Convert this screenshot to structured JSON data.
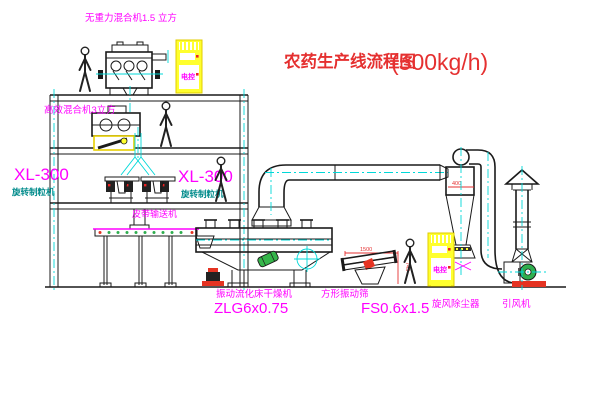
{
  "title": {
    "name": "农药生产线流程图",
    "capacity": "(500kg/h)"
  },
  "equipment": {
    "top_mixer": {
      "label": "无重力混合机1.5 立方"
    },
    "floor2_mixer": {
      "label": "高效混合机3立方"
    },
    "granulator_left": {
      "model": "XL-300",
      "name": "旋转制粒机"
    },
    "granulator_right": {
      "model": "XL-300",
      "name": "旋转制粒机"
    },
    "belt_conveyor": {
      "label": "皮带输送机"
    },
    "dryer": {
      "name": "振动流化床干燥机",
      "model": "ZLG6x0.75"
    },
    "sieve": {
      "name": "方形振动筛",
      "model": "FS0.6x1.5"
    },
    "cyclone": {
      "label": "旋风除尘器",
      "dim": "400"
    },
    "fan": {
      "label": "引风机"
    },
    "cabinet_upper": {
      "label": "电控"
    },
    "cabinet_lower": {
      "label": "电控"
    }
  },
  "dimensions": {
    "sieve_width": "1500",
    "sieve_height": "745"
  },
  "colors": {
    "line": "#1a1a1a",
    "centerline": "#00d8d8",
    "label": "#ff00ff",
    "title": "#e53030",
    "cabinet": "#ffff2e",
    "fan_green": "#2fae4e",
    "base_red": "#e53322"
  }
}
